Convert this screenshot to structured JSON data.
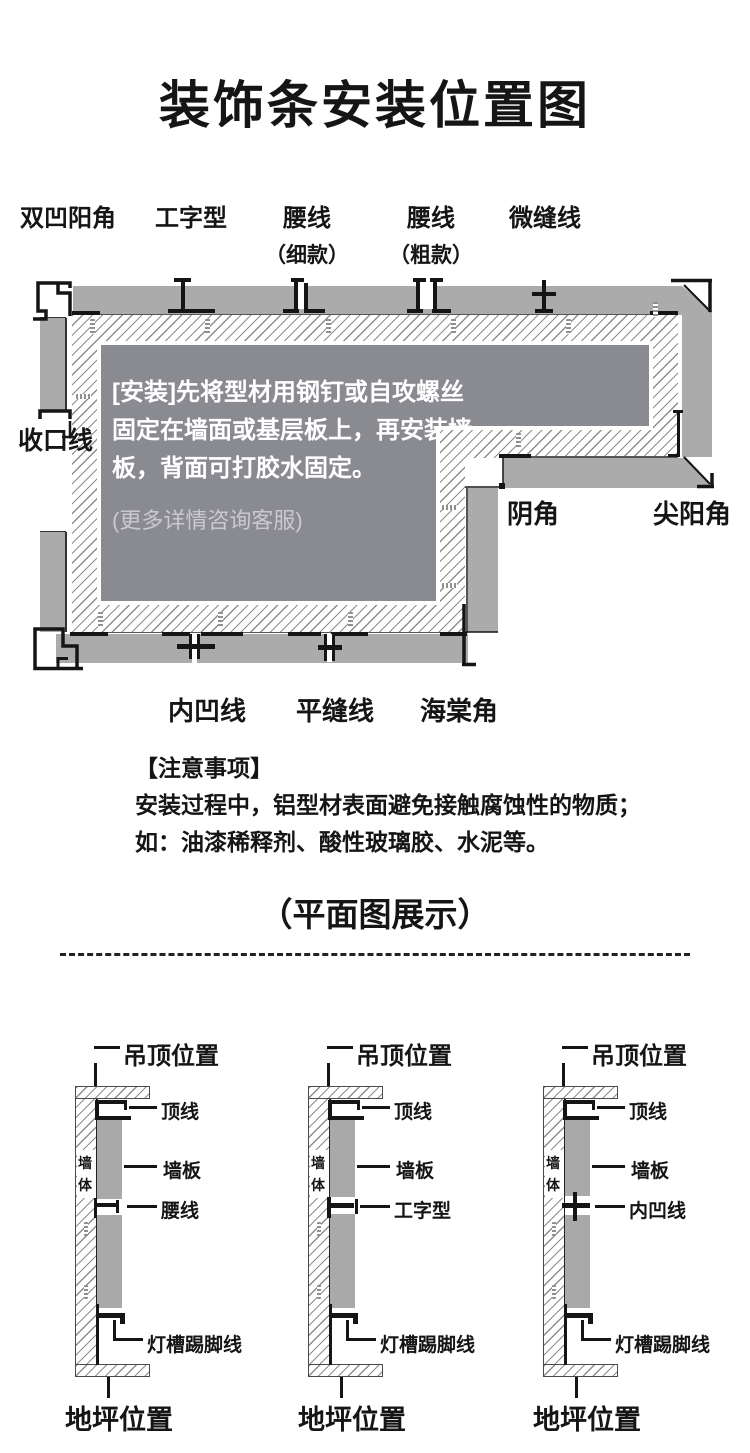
{
  "title": "装饰条安装位置图",
  "plan": {
    "top_labels": [
      {
        "label": "双凹阳角",
        "sub": ""
      },
      {
        "label": "工字型",
        "sub": ""
      },
      {
        "label": "腰线",
        "sub": "（细款）"
      },
      {
        "label": "腰线",
        "sub": "（粗款）"
      },
      {
        "label": "微缝线",
        "sub": ""
      }
    ],
    "left_label": "收口线",
    "inner_corner_label": "阴角",
    "sharp_corner_label": "尖阳角",
    "bottom_labels": [
      "内凹线",
      "平缝线",
      "海棠角"
    ],
    "panel_text": {
      "lines": [
        "[安装]先将型材用钢钉或自攻螺丝",
        "固定在墙面或基层板上，再安装墙",
        "板，背面可打胶水固定。"
      ],
      "note": "(更多详情咨询客服)"
    }
  },
  "notice": {
    "heading": "【注意事项】",
    "lines": [
      "安装过程中，铝型材表面避免接触腐蚀性的物质；",
      "如：油漆稀释剂、酸性玻璃胶、水泥等。"
    ]
  },
  "plan_view": {
    "title": "（平面图展示）"
  },
  "sections": [
    {
      "ceiling_label": "吊顶位置",
      "top_trim": "顶线",
      "wall_panel": "墙板",
      "middle_trim": "腰线",
      "skirting": "灯槽踢脚线",
      "floor_label": "地坪位置",
      "wall": "墙体"
    },
    {
      "ceiling_label": "吊顶位置",
      "top_trim": "顶线",
      "wall_panel": "墙板",
      "middle_trim": "工字型",
      "skirting": "灯槽踢脚线",
      "floor_label": "地坪位置",
      "wall": "墙体"
    },
    {
      "ceiling_label": "吊顶位置",
      "top_trim": "顶线",
      "wall_panel": "墙板",
      "middle_trim": "内凹线",
      "skirting": "灯槽踢脚线",
      "floor_label": "地坪位置",
      "wall": "墙体"
    }
  ],
  "colors": {
    "wall_band": "#ababab",
    "inner_panel": "#8a8a91",
    "ink": "#151515",
    "note_text": "#c9c9ce",
    "hatch_line": "#8d8d8d"
  }
}
